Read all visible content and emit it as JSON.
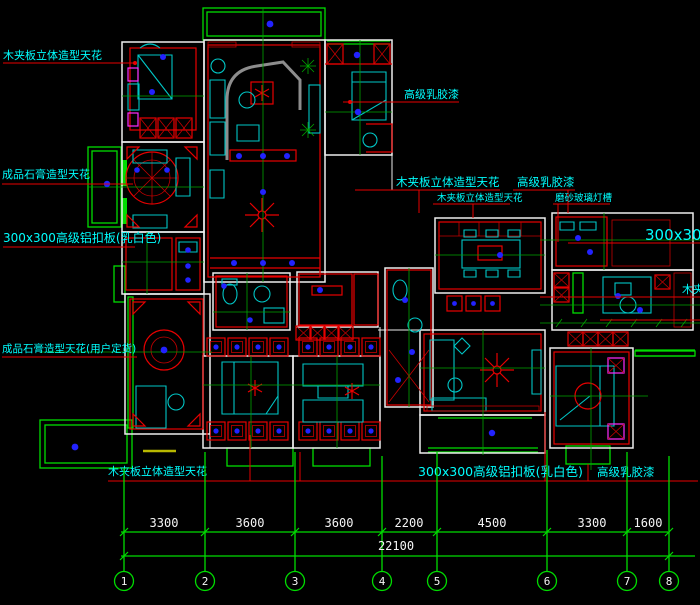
{
  "drawing": {
    "title_hint": "ceiling plan CAD drawing",
    "labels": {
      "tl_wood_ceiling": "木夹板立体造型天花",
      "left_gypsum_ceiling": "成品石膏造型天花",
      "left_alum_panel": "300x300高级铝扣板(乳白色)",
      "left_gypsum_custom": "成品石膏造型天花(用户定货)",
      "bottom_wood_ceiling": "木夹板立体造型天花",
      "bottom_alum_panel": "300x300高级铝扣板(乳白色)",
      "bottom_latex_paint": "高级乳胶漆",
      "top_latex_paint": "高级乳胶漆",
      "mid_wood_ceiling_lg": "木夹板立体造型天花",
      "mid_wood_ceiling_sm": "木夹板立体造型天花",
      "mid_latex_paint": "高级乳胶漆",
      "frosted_glass_trough": "磨砂玻璃灯槽",
      "right_alum_clipped": "300x300",
      "right_wood_clipped": "木夹板"
    },
    "dimensions": {
      "segments": [
        "3300",
        "3600",
        "3600",
        "2200",
        "4500",
        "3300",
        "1600"
      ],
      "total": "22100"
    },
    "grid_bubbles": [
      "1",
      "2",
      "3",
      "4",
      "5",
      "6",
      "7",
      "8"
    ],
    "colors": {
      "background": "#000000",
      "walls": "#ededed",
      "green_lines": "#00dc00",
      "red_details": "#e80000",
      "cyan_furniture": "#00c6c6",
      "label_text": "#00ffff",
      "dimension_text": "#f5f5f5",
      "light_dots": "#2222ff",
      "fixture_magenta": "#ff2bff"
    }
  }
}
